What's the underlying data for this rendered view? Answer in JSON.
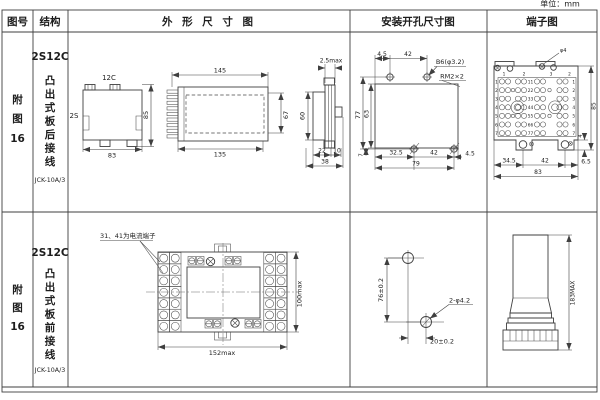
{
  "page": {
    "unit_label": "单位：mm"
  },
  "headers": {
    "fig_no": "图号",
    "structure": "结构",
    "outline": "外 形 尺 寸 图",
    "install": "安装开孔尺寸图",
    "terminal": "端子图"
  },
  "rows": [
    {
      "fig_label": [
        "附",
        "图",
        "16"
      ],
      "model": "2S12C",
      "structure_chars": [
        "凸",
        "出",
        "式",
        "板",
        "后",
        "接",
        "线"
      ],
      "type_code": "JCK-10A/3",
      "outline": {
        "front": {
          "top_tab": "12C",
          "side_tab": "2S",
          "height": "85",
          "width": "83"
        },
        "side": {
          "length_top": "145",
          "length_bottom": "135",
          "height_inner": "67"
        },
        "edge": {
          "flange_thickness": "2.5max",
          "body_height": "60",
          "depth_body": "22",
          "depth_flange": "10",
          "depth_total": "38"
        }
      },
      "install": {
        "offset_top": "4.5",
        "pitch_top": "42",
        "hole_label": "B6(φ3.2)",
        "thread_label": "RM2×2",
        "height_outer": "77",
        "height_inner": "63",
        "offset_bottom": "7",
        "bottom_1": "32.5",
        "bottom_2": "42",
        "bottom_3": "4.5",
        "width_total": "79"
      },
      "terminal": {
        "screw_label": "φ4",
        "col_labels": [
          "1",
          "2",
          "3",
          "2"
        ],
        "row_numbers": [
          "1",
          "2",
          "3",
          "4",
          "5",
          "6",
          "7"
        ],
        "pair_labels": [
          "11",
          "22",
          "33",
          "44",
          "55",
          "66",
          "77"
        ],
        "bottom_1": "34.5",
        "bottom_2": "42",
        "bottom_3": "6.5",
        "width_total": "83",
        "height": "85",
        "foot_offset": "4"
      }
    },
    {
      "fig_label": [
        "附",
        "图",
        "16"
      ],
      "model": "2S12C",
      "structure_chars": [
        "凸",
        "出",
        "式",
        "板",
        "前",
        "接",
        "线"
      ],
      "type_code": "JCK-10A/3",
      "outline": {
        "note": "31、41为电流端子",
        "width": "152max",
        "height": "100max"
      },
      "install": {
        "vertical": "76±0.2",
        "holes": "2-φ4.2",
        "horizontal": "20±0.2"
      },
      "terminal": {
        "height": "183MAX"
      }
    }
  ]
}
